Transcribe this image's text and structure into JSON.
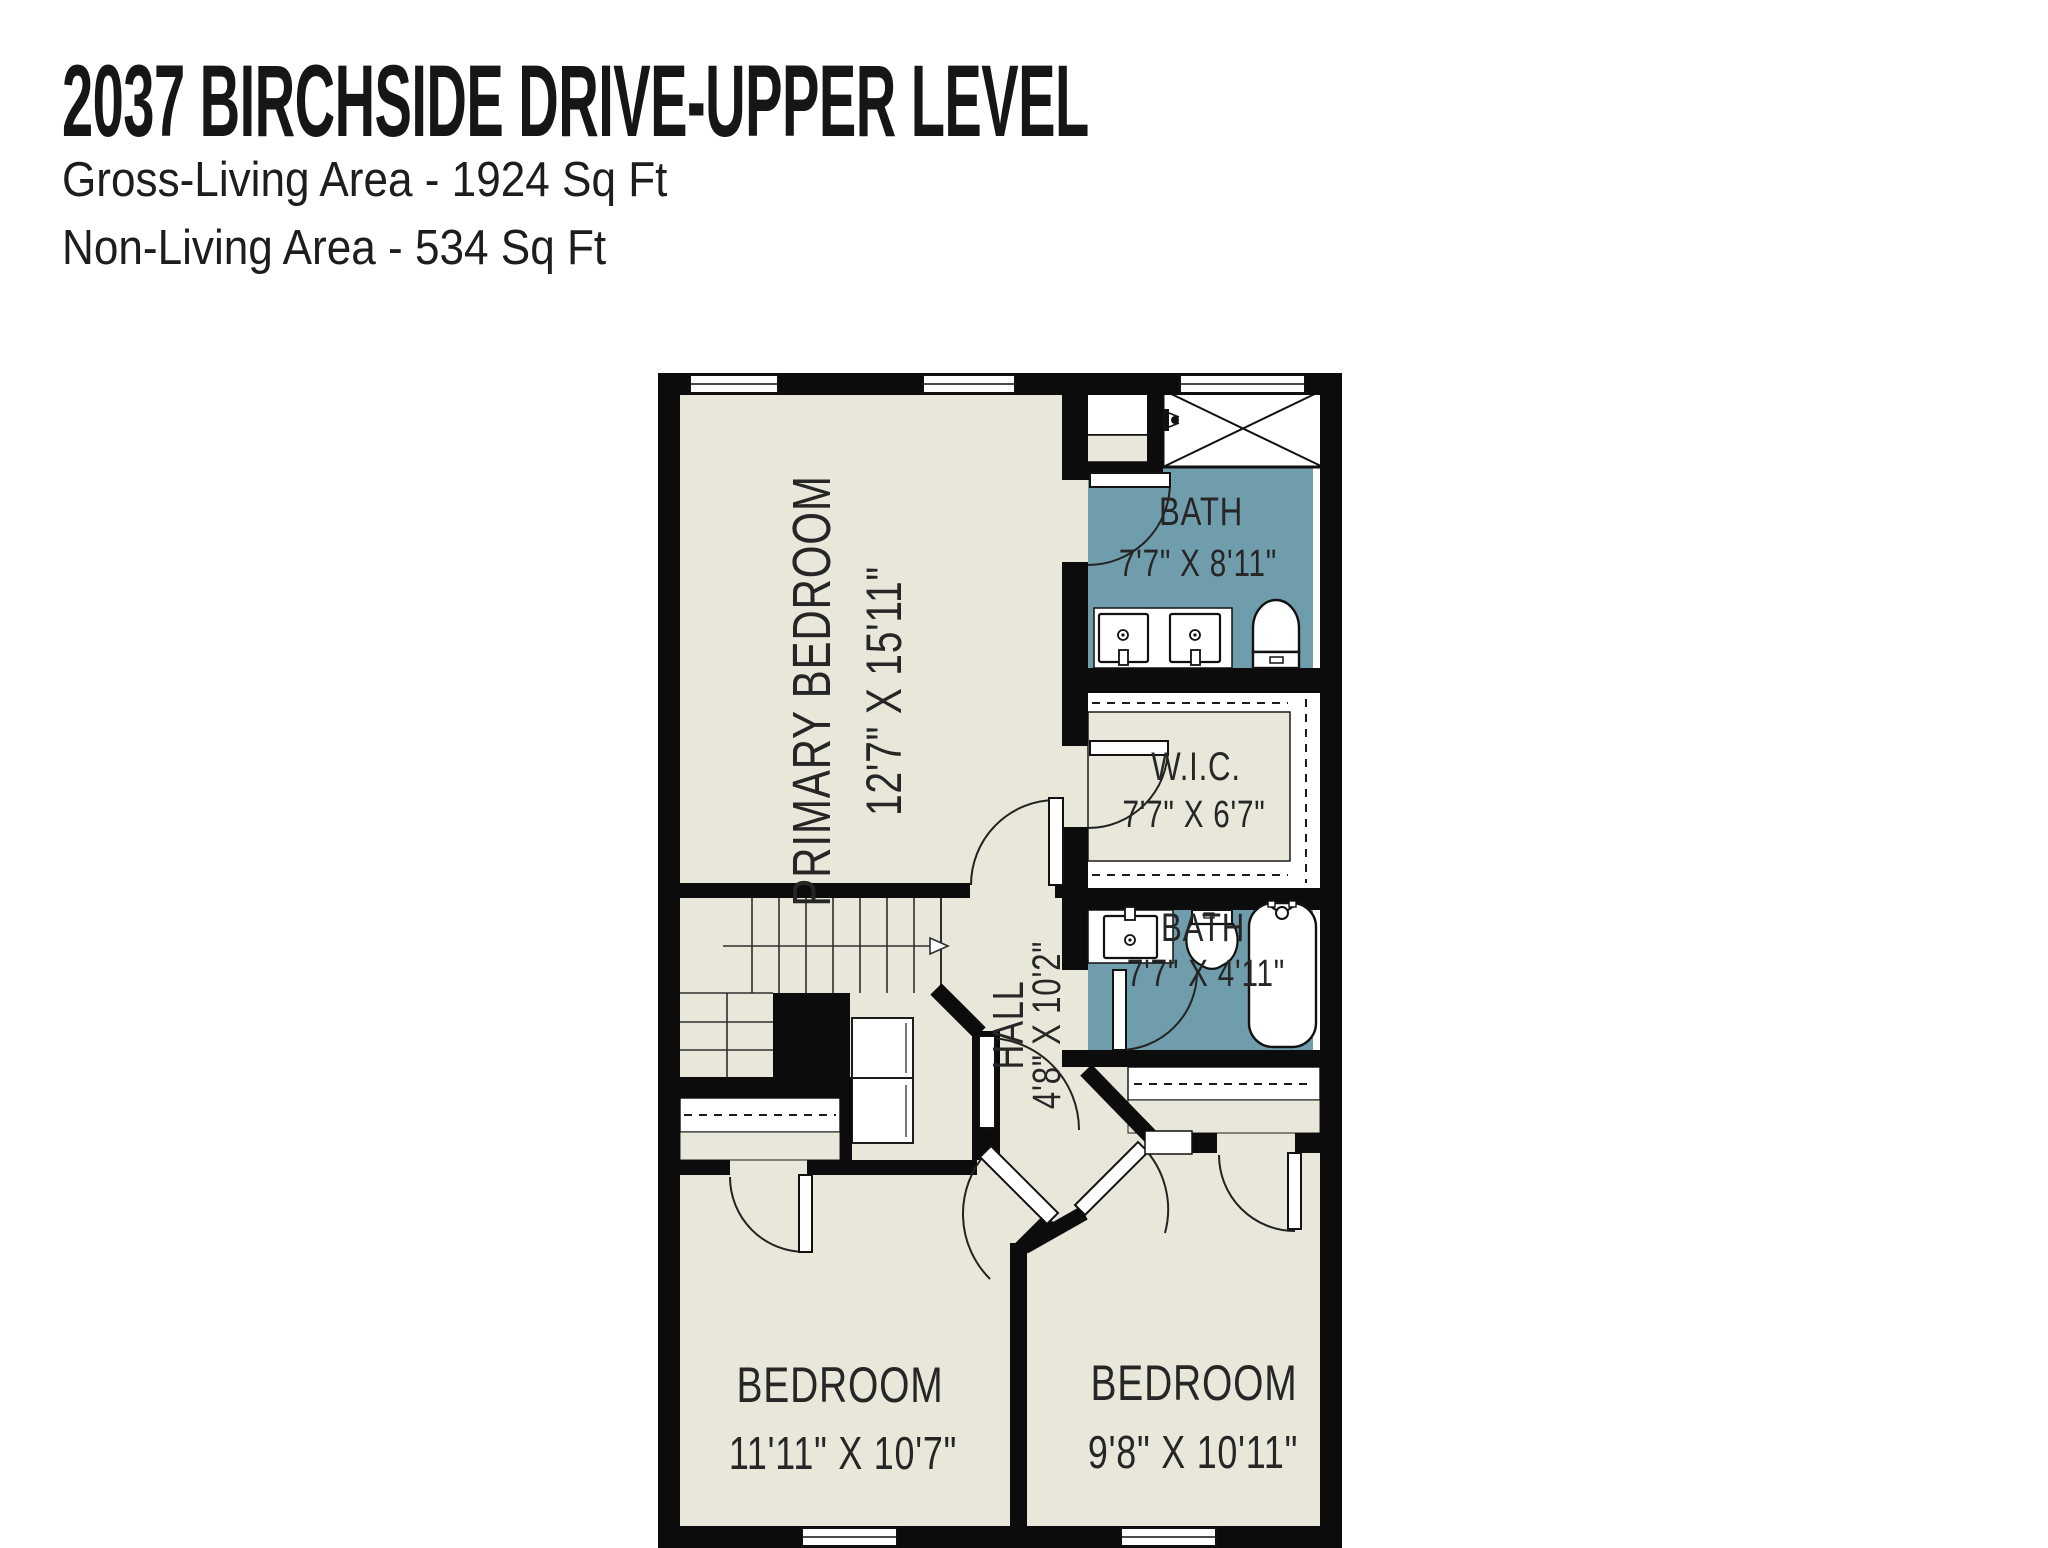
{
  "header": {
    "title": "2037 BIRCHSIDE DRIVE-UPPER LEVEL",
    "subtitle1": "Gross-Living Area - 1924 Sq Ft",
    "subtitle2": "Non-Living Area - 534 Sq Ft"
  },
  "rooms": {
    "primary_bedroom": {
      "name": "PRIMARY BEDROOM",
      "dims": "12'7\" X 15'11\""
    },
    "bath1": {
      "name": "BATH",
      "dims": "7'7\" X 8'11\""
    },
    "wic": {
      "name": "W.I.C.",
      "dims": "7'7\" X 6'7\""
    },
    "bath2": {
      "name": "BATH",
      "dims": "7'7\" X 4'11\""
    },
    "hall": {
      "name": "HALL",
      "dims": "4'8\" X 10'2\""
    },
    "bedroom_left": {
      "name": "BEDROOM",
      "dims": "11'11\" X 10'7\""
    },
    "bedroom_right": {
      "name": "BEDROOM",
      "dims": "9'8\" X 10'11\""
    }
  },
  "colors": {
    "floor_cream": "#e9e6da",
    "bath_teal": "#6f9dac",
    "wall_black": "#0c0c0c",
    "fixture_white": "#ffffff"
  }
}
